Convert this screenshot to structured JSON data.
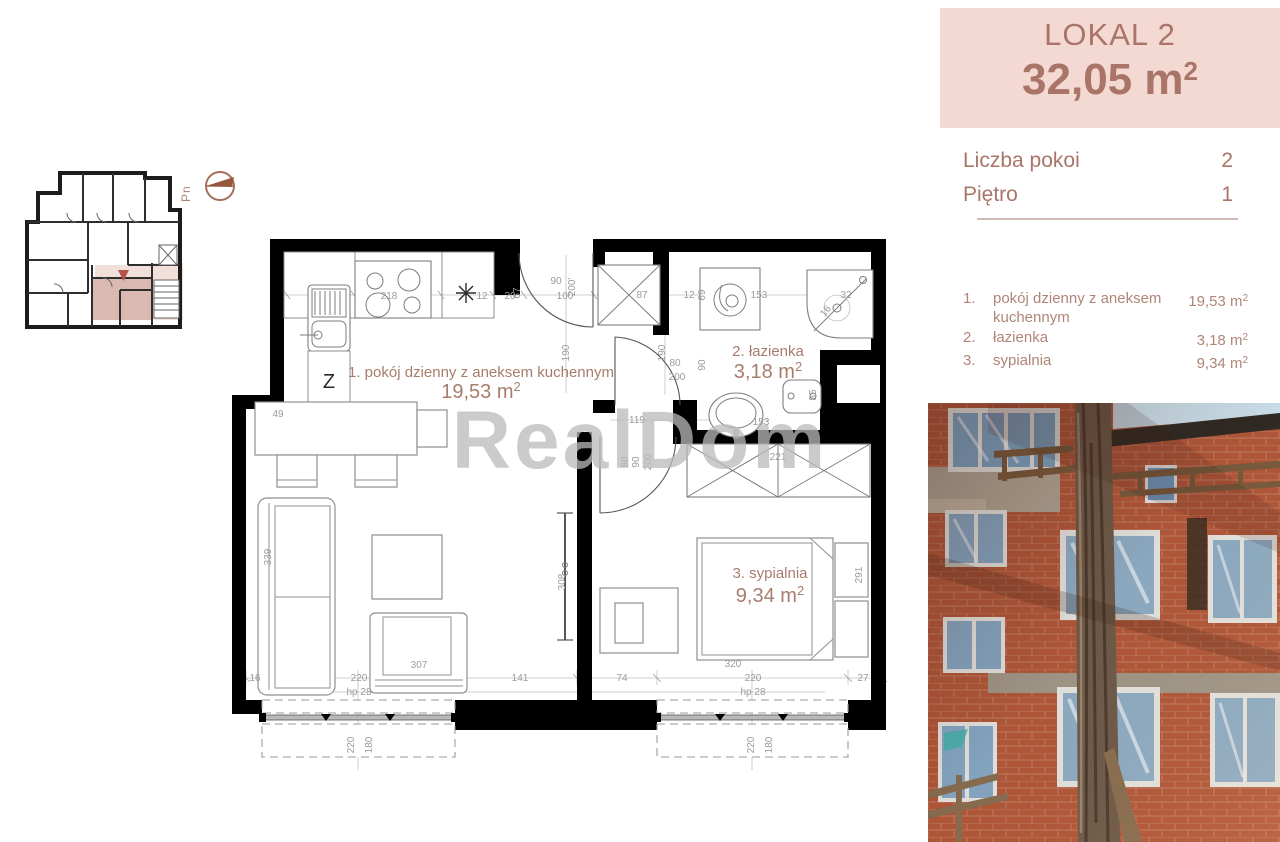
{
  "sidebar": {
    "lokal_title": "LOKAL 2",
    "lokal_area": "32,05 m",
    "lokal_area_sup": "2",
    "details": [
      {
        "label": "Liczba pokoi",
        "value": "2"
      },
      {
        "label": "Piętro",
        "value": "1"
      }
    ],
    "rooms": [
      {
        "num": "1.",
        "name": "pokój dzienny z aneksem kuchennym",
        "area": "19,53 m",
        "sup": "2"
      },
      {
        "num": "2.",
        "name": "łazienka",
        "area": "3,18 m",
        "sup": "2"
      },
      {
        "num": "3.",
        "name": "sypialnia",
        "area": "9,34 m",
        "sup": "2"
      }
    ]
  },
  "plan": {
    "watermark": "RealDom",
    "north_label": "Pn",
    "appliance_label": "Z",
    "room_labels": [
      {
        "title": "1. pokój dzienny z aneksem kuchennym",
        "area": "19,53 m",
        "sup": "2"
      },
      {
        "title": "2. łazienka",
        "area": "3,18 m",
        "sup": "2"
      },
      {
        "title": "3. sypialnia",
        "area": "9,34 m",
        "sup": "2"
      }
    ],
    "dims": [
      "218",
      "12",
      "20",
      "67",
      "90",
      "100",
      "200'",
      "190",
      "87",
      "12",
      "69",
      "153",
      "32",
      "16",
      "190",
      "80",
      "200",
      "90",
      "119",
      "153",
      "85",
      "49",
      "339",
      "307",
      "308",
      "221",
      "80",
      "90",
      "200",
      "291",
      "320",
      "16",
      "220",
      "141",
      "74",
      "220",
      "27",
      "hp 28",
      "hp 28",
      "220",
      "180",
      "220",
      "180"
    ]
  },
  "colors": {
    "panel_bg": "#f4d8d2",
    "panel_text": "#a87568",
    "walls": "#000000",
    "dim_text": "#9b9b9b",
    "label_text": "#a87c6c",
    "highlight_dark": "#d9b9b0",
    "highlight_light": "#f1e0da",
    "marker": "#b5524a"
  }
}
